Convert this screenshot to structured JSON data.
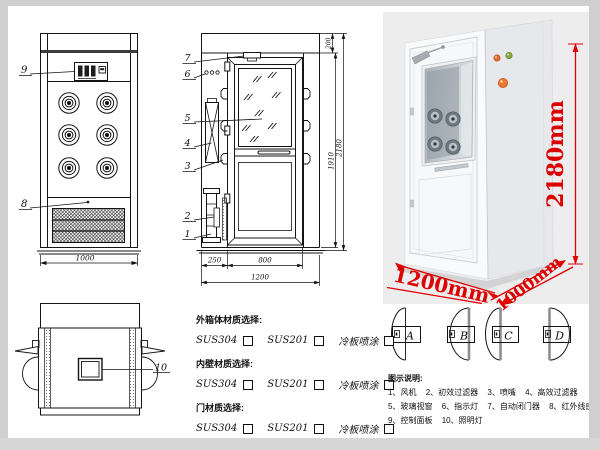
{
  "front_view": {
    "callout_9": "9",
    "callout_8": "8",
    "dim_width": "1000"
  },
  "section_view": {
    "callout_7": "7",
    "callout_6": "6",
    "callout_5": "5",
    "callout_4": "4",
    "callout_3": "3",
    "callout_2": "2",
    "callout_1": "1",
    "dim_top": "200",
    "dim_door_height": "1910",
    "dim_total_height": "2180",
    "dim_left_depth": "250",
    "dim_door_width": "800",
    "dim_total_width": "1200"
  },
  "top_view": {
    "callout_10": "10"
  },
  "photo": {
    "dim_height": "2180mm",
    "dim_width": "1200mm",
    "dim_depth": "1000mm",
    "annotation_color": "#dd0000"
  },
  "materials": {
    "groups": [
      {
        "label": "外箱体材质选择:",
        "options": [
          "SUS304",
          "SUS201",
          "冷板喷涂"
        ]
      },
      {
        "label": "内壁材质选择:",
        "options": [
          "SUS304",
          "SUS201",
          "冷板喷涂"
        ]
      },
      {
        "label": "门材质选择:",
        "options": [
          "SUS304",
          "SUS201",
          "冷板喷涂"
        ]
      }
    ]
  },
  "door_configs": {
    "labels": [
      "A",
      "B",
      "C",
      "D"
    ]
  },
  "legend": {
    "title": "图示说明:",
    "lines": [
      [
        "1、风机",
        "2、初效过滤器",
        "3、喷嘴",
        "4、高效过滤器"
      ],
      [
        "5、玻璃视窗",
        "6、指示灯",
        "7、自动闭门器",
        "8、红外线感应器"
      ],
      [
        "9、控制面板",
        "10、照明灯"
      ]
    ]
  }
}
